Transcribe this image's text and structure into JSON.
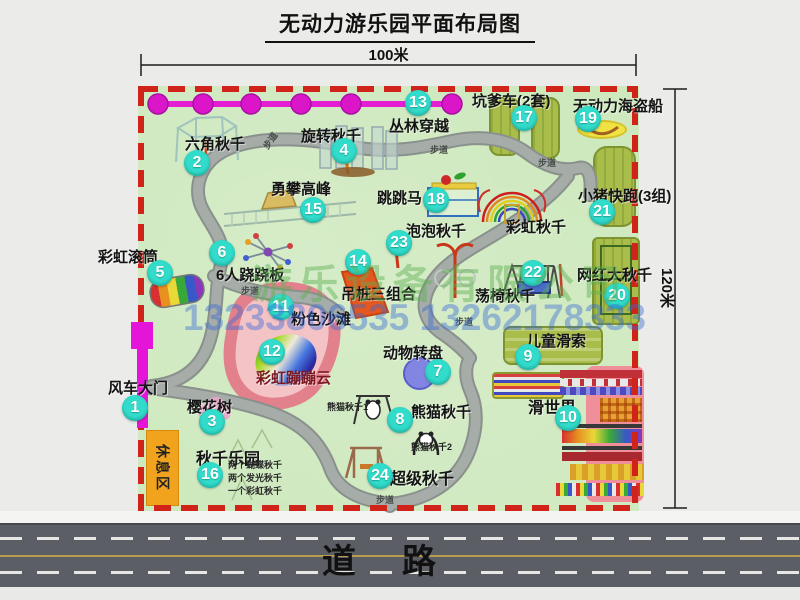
{
  "title": "无动力游乐园平面布局图",
  "dims": {
    "width": "100米",
    "height": "120米"
  },
  "road": {
    "label": "道路"
  },
  "walkway_label": "步道",
  "rest_area_label": "休息区",
  "watermark": {
    "company": "游乐设备有限公司",
    "phone": "13233806535 13262178333"
  },
  "extra_labels": {
    "rainbow_swing": "彩虹秋千",
    "panda_swing_1": "熊猫秋千1",
    "panda_swing_2": "熊猫秋千2"
  },
  "swing_park_notes": [
    "两个蝴蝶秋千",
    "两个发光秋千",
    "一个彩虹秋千"
  ],
  "attractions": [
    {
      "num": "1",
      "label": "风车大门"
    },
    {
      "num": "2",
      "label": "六角秋千"
    },
    {
      "num": "3",
      "label": "樱花树"
    },
    {
      "num": "4",
      "label": "旋转秋千"
    },
    {
      "num": "5",
      "label": "彩虹滚筒"
    },
    {
      "num": "6",
      "label": "6人跷跷板"
    },
    {
      "num": "7",
      "label": "动物转盘"
    },
    {
      "num": "8",
      "label": "熊猫秋千"
    },
    {
      "num": "9",
      "label": "儿童滑索"
    },
    {
      "num": "10",
      "label": "滑世界"
    },
    {
      "num": "11",
      "label": "粉色沙滩"
    },
    {
      "num": "12",
      "label": "彩虹蹦蹦云"
    },
    {
      "num": "13",
      "label": "丛林穿越"
    },
    {
      "num": "14",
      "label": "吊桩三组合"
    },
    {
      "num": "15",
      "label": "勇攀高峰"
    },
    {
      "num": "16",
      "label": "秋千乐园"
    },
    {
      "num": "17",
      "label": "坑爹车(2套)"
    },
    {
      "num": "18",
      "label": "跳跳马"
    },
    {
      "num": "19",
      "label": "无动力海盗船"
    },
    {
      "num": "20",
      "label": "网红大秋千"
    },
    {
      "num": "21",
      "label": "小猪快跑(3组)"
    },
    {
      "num": "22",
      "label": "荡椅秋千"
    },
    {
      "num": "23",
      "label": "泡泡秋千"
    },
    {
      "num": "24",
      "label": "超级秋千"
    }
  ]
}
